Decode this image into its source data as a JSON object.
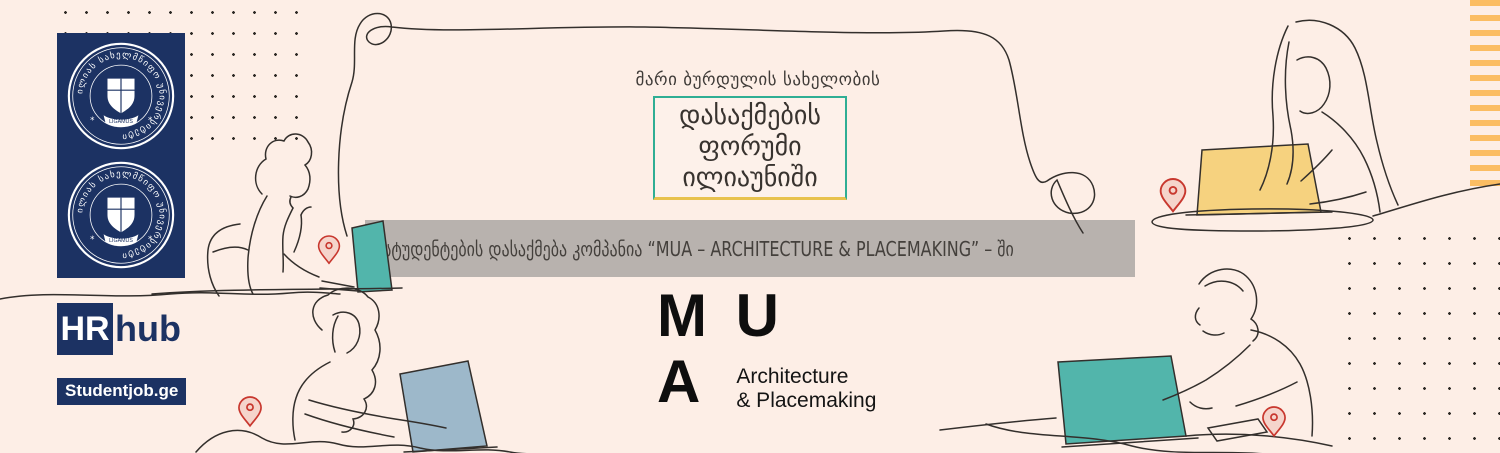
{
  "colors": {
    "background": "#fdeee6",
    "navy": "#1c3263",
    "teal_laptop": "#52b5ab",
    "yellow_laptop": "#f6d27f",
    "bluegray_laptop": "#9db8ca",
    "orange_stripe": "#fbbd63",
    "banner_bg": "#b8b2ae",
    "box_border_teal": "#2fae94",
    "box_border_yellow": "#e8c24d",
    "pin_red": "#c8372e",
    "line_ink": "#332f2c"
  },
  "seals": {
    "ring_text": "ილიას სახელმწიფო უნივერსიტეტი",
    "ribbon_text": "LIGAMUS"
  },
  "partners": {
    "hrhub_hr": "HR",
    "hrhub_hub": "hub",
    "studentjob": "Studentjob.ge"
  },
  "heading": {
    "eyebrow": "მარი ბურდულის სახელობის",
    "box_line1": "დასაქმების",
    "box_line2": "ფორუმი",
    "box_line3": "ილიაუნიში"
  },
  "banner": {
    "text": "სტუდენტების დასაქმება კომპანია “MUA – ARCHITECTURE & PLACEMAKING” – ში"
  },
  "mua_logo": {
    "row1": "M U",
    "row2": "A",
    "tag1": "Architecture",
    "tag2": "& Placemaking"
  }
}
